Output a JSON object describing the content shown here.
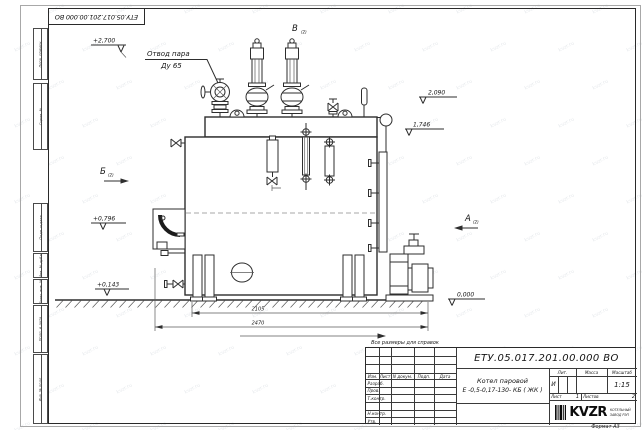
{
  "sheet": {
    "doc_number": "ЕТУ.05.017.201.00.000  ВО",
    "format_label": "Формат А3",
    "watermark": "kvzr.ru"
  },
  "margin_boxes": [
    "Перв. примен.",
    "Справ. №",
    "Подп. и дата",
    "Инв. № дубл.",
    "Взам. инв. №",
    "Подп. и дата",
    "Инв. № подл."
  ],
  "title_block": {
    "doc_number": "ЕТУ.05.017.201.00.000  ВО",
    "name_line1": "Котел паровой",
    "name_line2": "Е -0,5-0,17-130- КБ ( ЖК )",
    "col_izm": "Изм.",
    "col_list": "Лист",
    "col_doc": "N докум.",
    "col_podp": "Подп.",
    "col_data": "Дата",
    "rows": [
      "Разраб.",
      "Пров.",
      "Т.контр.",
      "",
      "Н.контр.",
      "Утв."
    ],
    "lit_label": "Лит.",
    "mass_label": "Масса",
    "scale_label": "Масштаб",
    "lit_value": "И",
    "mass_value": "",
    "scale_value": "1:15",
    "sheet_label": "Лист",
    "sheet_value": "1",
    "sheets_label": "Листов",
    "sheets_value": "2",
    "company_logo": "KVZR",
    "company_line1": "КОТЕЛЬНЫЙ",
    "company_line2": "ЗАВОД РЭП"
  },
  "drawing": {
    "steam_label1": "Отвод пара",
    "steam_label2": "Ду 65",
    "view_v": "В",
    "view_b": "Б",
    "view_a": "А",
    "view_sub": "(2)",
    "elev_top": "+2,700",
    "elev_2090": "2,090",
    "elev_1746": "1,746",
    "elev_0796": "+0,796",
    "elev_0143": "+0,143",
    "elev_zero": "0,000",
    "dim_inner": "2105",
    "dim_outer": "2470",
    "note": "Все размеры для справок"
  }
}
